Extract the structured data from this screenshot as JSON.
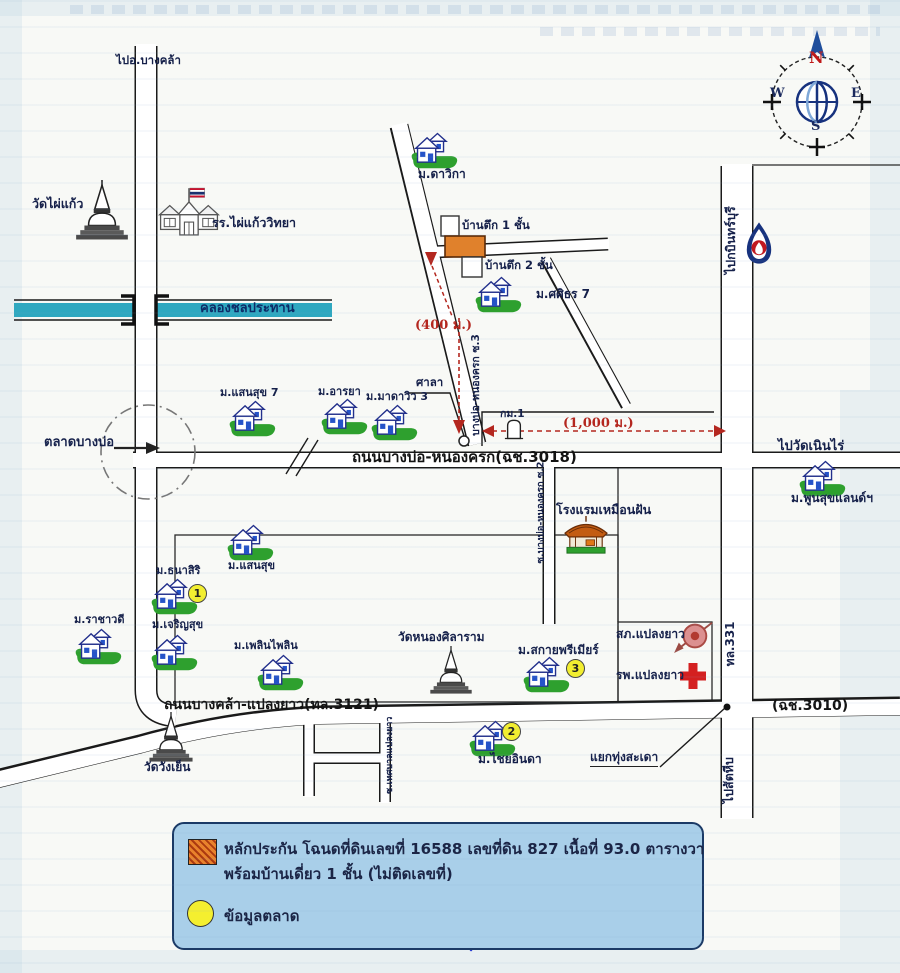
{
  "compass": {
    "north": "N",
    "south": "S",
    "east": "E",
    "west": "W"
  },
  "canal": {
    "label": "คลองชลประทาน"
  },
  "roads": {
    "to_bangkhla": "ไปอ.บางคล้า",
    "main_road": "ถนนบางบ่อ-หนองครก(ฉช.3018)",
    "soi3": "บางบ่อ-หนองครก ซ.3",
    "soi2": "ซ.บางบ่อ-หนองครก ซ.2",
    "soi_municipal": "ซ.เทศบาลแปลงยาว",
    "bottom_road": "ถนนบางคล้า-แปลงยาว(ทล.3121)",
    "route_3010": "(ฉช.3010)",
    "highway_331": "ทล.331",
    "to_kabinburi": "ไปกบินทร์บุรี",
    "to_sattahip": "ไปสัตหีบ",
    "to_wat_noen_rai": "ไปวัดเนินไร่",
    "junction_thung_sadao": "แยกทุ่งสะเดา"
  },
  "places": {
    "wat_phai_kaew": "วัดไผ่แก้ว",
    "school": "รร.ไผ่แก้ววิทยา",
    "market": "ตลาดบางบ่อ",
    "hotel": "โรงแรมเหมือนฝัน",
    "wat_nong_silaram": "วัดหนองศิลาราม",
    "wat_wang_yen": "วัดวังเย็น",
    "police": "สภ.แปลงยาว",
    "hospital": "รพ.แปลงยาว",
    "sala": "ศาลา",
    "km1": "กม.1"
  },
  "villages": {
    "davika": "ม.ดาวิกา",
    "sasithorn": "ม.ศศิธร 7",
    "sansuk7": "ม.แสนสุข 7",
    "araya": "ม.อารยา",
    "madaview": "ม.มาดาวิว 3",
    "poonsuk_land": "ม.พูนสุขแลนด์ฯ",
    "sansuk": "ม.แสนสุข",
    "thanasiri": "ม.ธนาสิริ",
    "rachawadee": "ม.ราชาวดี",
    "charoensuk": "ม.เจริญสุข",
    "ploenpailin": "ม.เพลินไพลิน",
    "sky_premier": "ม.สกายพรีเมียร์",
    "chaiya_inda": "ม.ไชยอินดา"
  },
  "buildings": {
    "b1": "บ้านตึก 1 ชั้น",
    "b2": "บ้านตึก 2 ชั้น"
  },
  "distances": {
    "d400": "(400 ม.)",
    "d1000": "(1,000 ม.)"
  },
  "badges": {
    "one": "1",
    "two": "2",
    "three": "3"
  },
  "legend": {
    "collateral_line1": "หลักประกัน โฉนดที่ดินเลขที่ 16588 เลขที่ดิน 827 เนื้อที่ 93.0 ตารางวา",
    "collateral_line2": "พร้อมบ้านเดี่ยว 1 ชั้น (ไม่ติดเลขที่)",
    "market_info": "ข้อมูลตลาด"
  },
  "colors": {
    "canal_blue": "#2fa8c0",
    "collateral_orange": "#e0812c",
    "market_yellow": "#f2ee30",
    "legend_bg": "#a9cfe9",
    "distance_red": "#b4271f",
    "house_green": "#2ea02e",
    "house_navy": "#23308c",
    "compass_blue": "#17327e"
  }
}
